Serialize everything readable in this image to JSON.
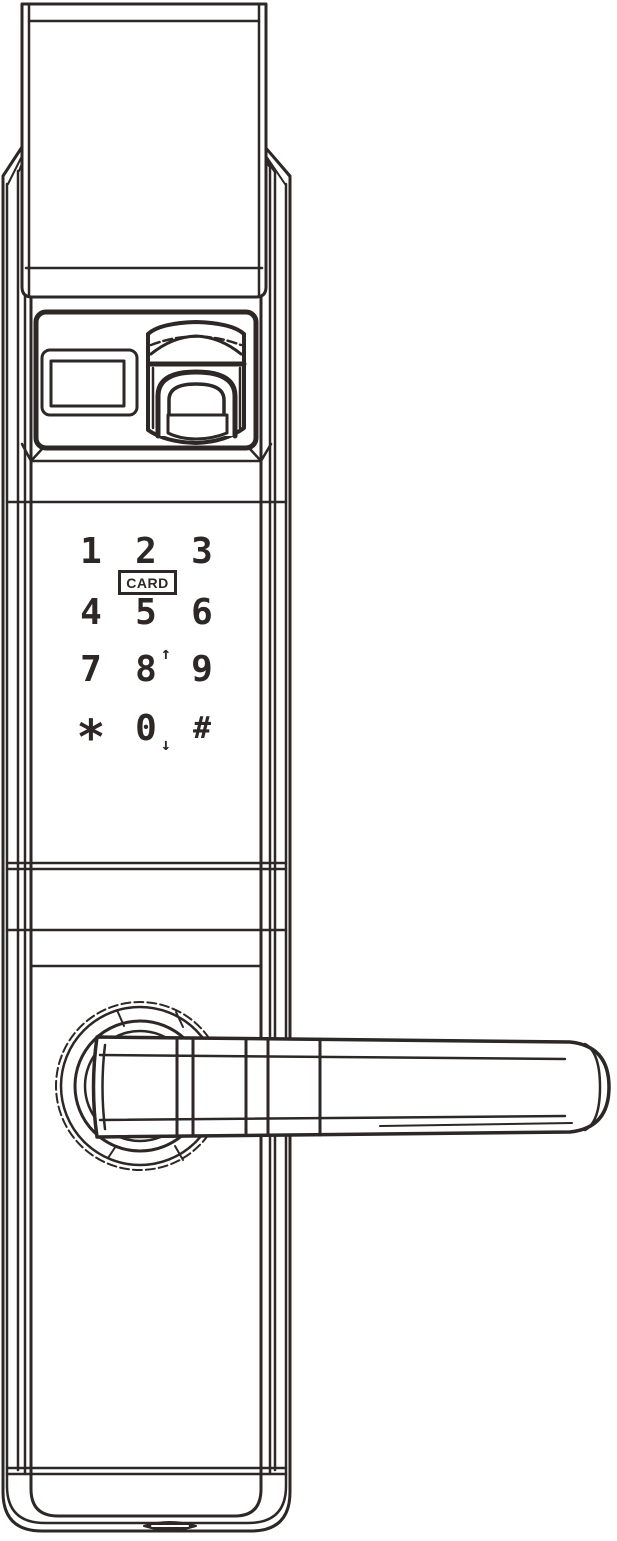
{
  "colors": {
    "line": "#2d2726",
    "background": "#ffffff"
  },
  "keypad": {
    "card_label": "CARD",
    "keys": [
      {
        "label": "1"
      },
      {
        "label": "2"
      },
      {
        "label": "3"
      },
      {
        "label": "4"
      },
      {
        "label": "5"
      },
      {
        "label": "6"
      },
      {
        "label": "7"
      },
      {
        "label": "8",
        "arrow": "↑"
      },
      {
        "label": "9"
      },
      {
        "label": "*"
      },
      {
        "label": "0",
        "arrow": "↓"
      },
      {
        "label": "#"
      }
    ]
  },
  "parts": {
    "top_cap": "top-mounting-cap",
    "display_window": "display-window",
    "fingerprint_reader": "fingerprint-reader",
    "keypad": "touch-keypad",
    "card_reader": "card-reader-zone",
    "handle_rosette": "handle-rosette",
    "handle_lever": "door-handle-lever",
    "bottom_port": "bottom-port-slot"
  }
}
